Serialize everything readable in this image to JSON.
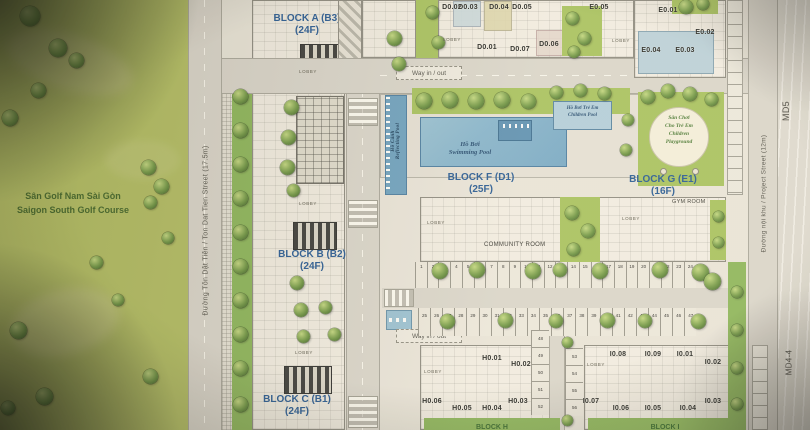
{
  "golf": {
    "name_vi": "Sân Golf Nam Sài Gòn",
    "name_en": "Saigon South Golf Course"
  },
  "streets": {
    "ton_dat_tien": "Đường Tôn Dật Tiên / Ton Dat Tien Street (17.5m)",
    "project": "Đường nội khu / Project Street (12m)",
    "md5": "MD5",
    "md4": "MD4-4"
  },
  "blocks": {
    "a": {
      "name": "BLOCK A (B3)",
      "floors": "(24F)"
    },
    "b": {
      "name": "BLOCK B (B2)",
      "floors": "(24F)"
    },
    "c": {
      "name": "BLOCK C (B1)",
      "floors": "(24F)"
    },
    "f": {
      "name": "BLOCK F (D1)",
      "floors": "(25F)"
    },
    "g": {
      "name": "BLOCK G (E1)",
      "floors": "(16F)"
    },
    "h": {
      "name": "BLOCK H"
    },
    "i": {
      "name": "BLOCK I"
    }
  },
  "amenities": {
    "swimming_pool_vi": "Hồ Bơi",
    "swimming_pool_en": "Swimming Pool",
    "children_pool_vi": "Hồ Bơi Trẻ Em",
    "children_pool_en": "Children Pool",
    "reflecting_pool_vi": "Hồ Cảnh",
    "reflecting_pool_en": "Reflecting Pool",
    "playground_lines": [
      "Sân Chơi",
      "Cho Trẻ Em",
      "Children",
      "Playground"
    ],
    "community_room": "COMMUNITY ROOM",
    "gym_room": "GYM ROOM",
    "lobby": "LOBBY",
    "way_in_out": "Way in / out"
  },
  "units": {
    "d": [
      "D0.02",
      "D0.03",
      "D0.04",
      "D0.05",
      "D0.01",
      "D0.07",
      "D0.06"
    ],
    "e": [
      "E0.05",
      "E0.01",
      "E0.02",
      "E0.04",
      "E0.03"
    ],
    "h": [
      "H0.01",
      "H0.02",
      "H0.03",
      "H0.04",
      "H0.05",
      "H0.06"
    ],
    "i": [
      "I0.01",
      "I0.02",
      "I0.03",
      "I0.04",
      "I0.05",
      "I0.06",
      "I0.07",
      "I0.08",
      "I0.09"
    ]
  },
  "parking": {
    "row1": [
      "1",
      "2",
      "3",
      "4",
      "5",
      "6",
      "7",
      "8",
      "9",
      "10",
      "11",
      "12",
      "13",
      "14",
      "15",
      "16",
      "17",
      "18",
      "19",
      "20",
      "21",
      "22",
      "23",
      "24"
    ],
    "row2": [
      "25",
      "26",
      "27",
      "28",
      "29",
      "30",
      "31",
      "32",
      "33",
      "34",
      "35",
      "36",
      "37",
      "38",
      "39",
      "40",
      "41",
      "42",
      "43",
      "44",
      "45",
      "46",
      "47"
    ],
    "col1": [
      "48",
      "49",
      "50",
      "51",
      "52"
    ],
    "col2": [
      "53",
      "54",
      "55",
      "56"
    ]
  },
  "colors": {
    "block_label": "#1a5ca6",
    "pool_blue": "#79b7d9",
    "golf_green": "#b2c24f",
    "median_green": "#85bb47",
    "playground_text": "#3f7d23"
  }
}
